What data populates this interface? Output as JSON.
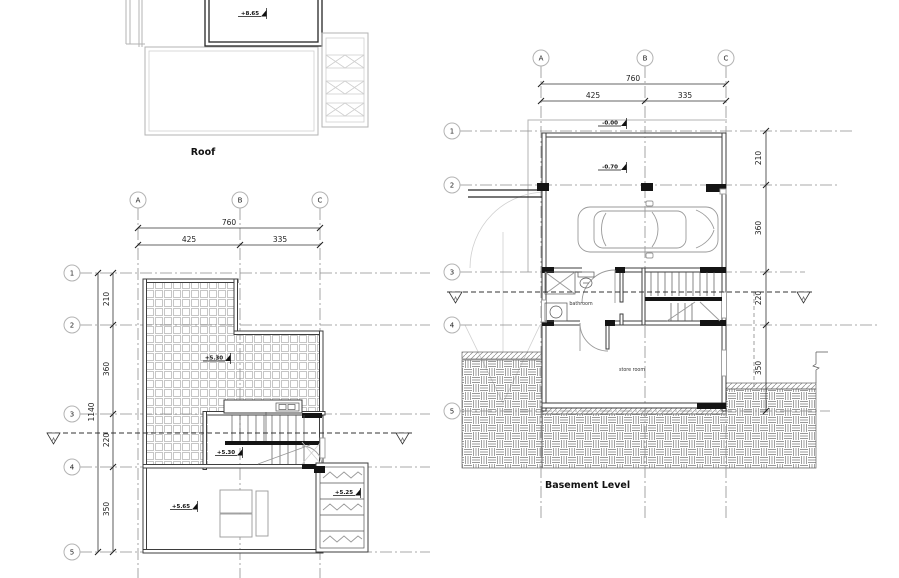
{
  "roof": {
    "title": "Roof",
    "elev_upper": "+8.65"
  },
  "terrace": {
    "grid_cols": [
      "A",
      "B",
      "C"
    ],
    "grid_rows": [
      "1",
      "2",
      "3",
      "4",
      "5"
    ],
    "dims": {
      "total_w": "760",
      "w1": "425",
      "w2": "335",
      "total_h": "1140",
      "h1": "210",
      "h2": "360",
      "h3": "220",
      "h4": "350"
    },
    "elev_terrace": "+5.30",
    "elev_stair_landing": "+5.30",
    "elev_room": "+5.65",
    "elev_planter": "+5.25",
    "section": "A"
  },
  "basement": {
    "title": "Basement Level",
    "grid_cols": [
      "A",
      "B",
      "C"
    ],
    "grid_rows": [
      "1",
      "2",
      "3",
      "4",
      "5"
    ],
    "dims": {
      "total_w": "760",
      "w1": "425",
      "w2": "335",
      "h1": "210",
      "h2": "360",
      "h3": "220",
      "h4": "350"
    },
    "elev_entry": "-0.00",
    "elev_garage": "-0.70",
    "room_bathroom": "bathroom",
    "room_store": "store room",
    "section": "A"
  }
}
